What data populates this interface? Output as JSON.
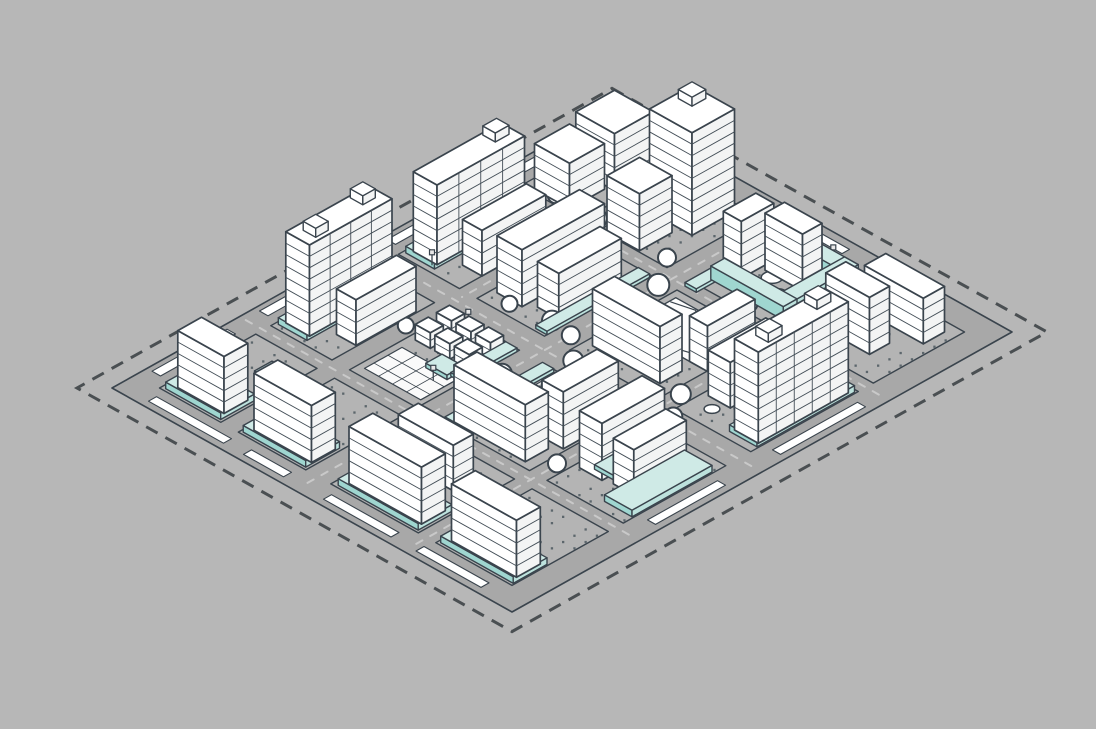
{
  "scene": {
    "kind": "isometric-urban-masterplan-illustration",
    "legend": {
      "water_platforms": "#cfeae6",
      "buildings": "#ffffff",
      "roads_ground": "#a8a8a8",
      "site_boundary": "dashed dark line",
      "trees": "white circles",
      "courtyards": "dotted gray"
    }
  },
  "colors": {
    "background": "#b7b7b7",
    "site": "#a8a8a8",
    "block": "#b4b4b4",
    "outline": "#3a444d",
    "stripe": "#434e57",
    "dash": "#4a4f52",
    "laneMark": "#c9c9c9",
    "median": "#ffffff",
    "dots": "#5c666c",
    "white": "#ffffff",
    "bldRight": "#f3f4f4",
    "waterTop": "#cfeae6",
    "waterLeft": "#9fd6d0",
    "waterRight": "#bde2dd",
    "parkFill": "#fcfcfc",
    "plazaFill": "#fafafa",
    "pondFill": "#ffffff",
    "glyph": "#3a444d"
  },
  "projection": {
    "origin": [
      612,
      108
    ],
    "ux": 25,
    "vy": 14,
    "zs": 30
  },
  "site": {
    "x": 0,
    "y": 0,
    "w": 16,
    "d": 20
  },
  "boundary": {
    "offset": 0.7,
    "dash": "13 9",
    "width": 3
  },
  "blocks": [
    {
      "id": "A1",
      "x": 0.95,
      "y": 0.95,
      "w": 2.45,
      "d": 3.65
    },
    {
      "id": "B1",
      "x": 4.1,
      "y": 0.95,
      "w": 2.7,
      "d": 3.65
    },
    {
      "id": "C1",
      "x": 7.8,
      "y": 0.95,
      "w": 3.5,
      "d": 3.65
    },
    {
      "id": "D1",
      "x": 12.0,
      "y": 0.95,
      "w": 3.05,
      "d": 3.65
    },
    {
      "id": "A2",
      "x": 0.95,
      "y": 5.2,
      "w": 2.45,
      "d": 4.3
    },
    {
      "id": "B2",
      "x": 4.1,
      "y": 5.2,
      "w": 2.7,
      "d": 4.3
    },
    {
      "id": "C2",
      "x": 7.8,
      "y": 5.2,
      "w": 3.5,
      "d": 4.3
    },
    {
      "id": "D2",
      "x": 12.0,
      "y": 5.2,
      "w": 3.05,
      "d": 4.3
    },
    {
      "id": "A3",
      "x": 0.95,
      "y": 10.5,
      "w": 2.45,
      "d": 4.1
    },
    {
      "id": "B3",
      "x": 4.1,
      "y": 10.5,
      "w": 2.7,
      "d": 4.1
    },
    {
      "id": "C3",
      "x": 7.8,
      "y": 10.5,
      "w": 3.5,
      "d": 4.1
    },
    {
      "id": "D3",
      "x": 12.0,
      "y": 10.5,
      "w": 3.05,
      "d": 4.1
    },
    {
      "id": "A4",
      "x": 0.95,
      "y": 15.2,
      "w": 2.45,
      "d": 3.85
    },
    {
      "id": "B4",
      "x": 4.1,
      "y": 15.2,
      "w": 2.7,
      "d": 3.85
    },
    {
      "id": "C4",
      "x": 7.8,
      "y": 15.2,
      "w": 3.5,
      "d": 3.85
    },
    {
      "id": "D4",
      "x": 12.0,
      "y": 15.2,
      "w": 3.05,
      "d": 3.85
    }
  ],
  "laneLines": [
    {
      "x1": 7.3,
      "y1": 0.25,
      "x2": 7.3,
      "y2": 19.75
    },
    {
      "x1": 0.25,
      "y1": 10.0,
      "x2": 15.75,
      "y2": 10.0
    },
    {
      "x1": 11.65,
      "y1": 0.25,
      "x2": 11.65,
      "y2": 19.75
    },
    {
      "x1": 3.75,
      "y1": 0.25,
      "x2": 3.75,
      "y2": 9.75
    },
    {
      "x1": 0.25,
      "y1": 4.9,
      "x2": 15.75,
      "y2": 4.9
    },
    {
      "x1": 0.25,
      "y1": 14.9,
      "x2": 15.75,
      "y2": 14.9
    }
  ],
  "medianStrips": [
    {
      "x": 0.2,
      "y": 1.2,
      "w": 0.34,
      "d": 3.2
    },
    {
      "x": 0.2,
      "y": 5.5,
      "w": 0.34,
      "d": 3.7
    },
    {
      "x": 0.2,
      "y": 10.8,
      "w": 0.34,
      "d": 3.5
    },
    {
      "x": 0.2,
      "y": 15.6,
      "w": 0.34,
      "d": 3.0
    },
    {
      "x": 1.2,
      "y": 19.42,
      "w": 3.0,
      "d": 0.32
    },
    {
      "x": 5.0,
      "y": 19.42,
      "w": 1.6,
      "d": 0.32
    },
    {
      "x": 8.2,
      "y": 19.42,
      "w": 2.7,
      "d": 0.32
    },
    {
      "x": 11.9,
      "y": 19.42,
      "w": 2.6,
      "d": 0.32
    },
    {
      "x": 15.42,
      "y": 5.6,
      "w": 0.32,
      "d": 3.4
    },
    {
      "x": 15.42,
      "y": 11.2,
      "w": 0.32,
      "d": 2.8
    },
    {
      "x": 8.3,
      "y": 0.3,
      "w": 1.5,
      "d": 0.3
    }
  ],
  "dotAreas": [
    {
      "x": 1.2,
      "y": 1.1,
      "w": 2.0,
      "d": 3.3
    },
    {
      "x": 4.2,
      "y": 1.0,
      "w": 2.5,
      "d": 3.4
    },
    {
      "x": 8.3,
      "y": 1.5,
      "w": 2.5,
      "d": 2.4
    },
    {
      "x": 12.1,
      "y": 1.0,
      "w": 2.8,
      "d": 3.3
    },
    {
      "x": 1.1,
      "y": 5.4,
      "w": 2.2,
      "d": 3.8
    },
    {
      "x": 4.2,
      "y": 5.4,
      "w": 2.4,
      "d": 3.8
    },
    {
      "x": 8.0,
      "y": 7.6,
      "w": 3.1,
      "d": 1.6
    },
    {
      "x": 12.1,
      "y": 5.4,
      "w": 2.7,
      "d": 3.8
    },
    {
      "x": 1.1,
      "y": 10.7,
      "w": 2.2,
      "d": 3.6
    },
    {
      "x": 4.2,
      "y": 10.7,
      "w": 2.4,
      "d": 1.8
    },
    {
      "x": 8.0,
      "y": 10.7,
      "w": 3.1,
      "d": 3.6
    },
    {
      "x": 12.1,
      "y": 10.7,
      "w": 2.7,
      "d": 3.6
    },
    {
      "x": 1.0,
      "y": 15.4,
      "w": 2.3,
      "d": 2.0
    },
    {
      "x": 4.2,
      "y": 15.4,
      "w": 2.4,
      "d": 2.0
    },
    {
      "x": 8.0,
      "y": 15.5,
      "w": 3.1,
      "d": 1.9
    },
    {
      "x": 12.1,
      "y": 15.4,
      "w": 2.7,
      "d": 2.0
    }
  ],
  "plaza": {
    "x": 4.35,
    "y": 12.75,
    "w": 2.25,
    "d": 1.5,
    "grid": 0.56
  },
  "park": {
    "x": 8.05,
    "y": 5.5,
    "w": 3.1,
    "d": 2.0,
    "curves": [
      [
        [
          8.1,
          5.75
        ],
        [
          8.9,
          5.55
        ],
        [
          9.7,
          6.35
        ],
        [
          10.5,
          5.95
        ],
        [
          11.1,
          6.3
        ]
      ],
      [
        [
          8.3,
          6.9
        ],
        [
          9.1,
          6.6
        ],
        [
          9.9,
          7.3
        ],
        [
          10.9,
          7.0
        ]
      ]
    ]
  },
  "ponds": [
    {
      "cx": 10.35,
      "cy": 6.7,
      "r": 0.33
    },
    {
      "cx": 9.25,
      "cy": 2.85,
      "r": 0.3
    },
    {
      "cx": 9.95,
      "cy": 3.3,
      "r": 0.24
    },
    {
      "cx": 9.7,
      "cy": 12.55,
      "r": 0.42
    },
    {
      "cx": 10.35,
      "cy": 12.3,
      "r": 0.3
    },
    {
      "cx": 8.85,
      "cy": 11.15,
      "r": 0.22
    },
    {
      "cx": 13.15,
      "cy": 7.0,
      "r": 0.3
    },
    {
      "cx": 12.75,
      "cy": 8.75,
      "r": 0.22
    },
    {
      "cx": 5.25,
      "cy": 2.1,
      "r": 0.26
    },
    {
      "cx": 2.1,
      "cy": 7.3,
      "r": 0.22
    }
  ],
  "playground": {
    "x": 8.35,
    "y": 10.95,
    "w": 1.05,
    "d": 0.95,
    "glyphs": [
      [
        8.62,
        11.3
      ],
      [
        9.02,
        11.5
      ],
      [
        8.72,
        11.72
      ]
    ]
  },
  "waterPrisms": [
    {
      "id": "w1",
      "x": 1.05,
      "y": 5.4,
      "w": 1.15,
      "d": 3.9,
      "h": 0.22,
      "k": 11.0
    },
    {
      "id": "w2",
      "x": 1.05,
      "y": 10.7,
      "w": 1.15,
      "d": 3.7,
      "h": 0.22,
      "k": 16.05
    },
    {
      "id": "w3",
      "x": 1.1,
      "y": 17.6,
      "w": 2.2,
      "d": 1.35,
      "h": 0.22,
      "k": 21.6
    },
    {
      "id": "w4",
      "x": 4.2,
      "y": 17.6,
      "w": 2.5,
      "d": 1.35,
      "h": 0.22,
      "k": 25.0
    },
    {
      "id": "w5",
      "x": 8.0,
      "y": 17.6,
      "w": 3.2,
      "d": 1.35,
      "h": 0.22,
      "k": 29.5
    },
    {
      "id": "w6",
      "x": 12.1,
      "y": 17.6,
      "w": 2.9,
      "d": 1.35,
      "h": 0.22,
      "k": 33.4
    },
    {
      "id": "w7",
      "x": 13.9,
      "y": 5.3,
      "w": 1.1,
      "d": 3.9,
      "h": 0.22,
      "k": 23.7
    },
    {
      "id": "w8",
      "x": 13.9,
      "y": 11.0,
      "w": 1.1,
      "d": 3.2,
      "h": 0.22
    },
    {
      "id": "w9",
      "x": 1.7,
      "y": 0.12,
      "w": 1.6,
      "d": 0.72,
      "h": 0.3
    },
    {
      "id": "c1",
      "x": 6.35,
      "y": 5.3,
      "w": 0.45,
      "d": 4.1,
      "h": 0.12
    },
    {
      "id": "c2",
      "x": 7.82,
      "y": 10.6,
      "w": 0.45,
      "d": 3.9,
      "h": 0.12
    },
    {
      "id": "c3",
      "x": 6.35,
      "y": 10.6,
      "w": 0.45,
      "d": 2.2,
      "h": 0.12
    },
    {
      "id": "c4",
      "x": 7.82,
      "y": 3.4,
      "w": 0.45,
      "d": 1.5,
      "h": 0.12
    },
    {
      "id": "u1",
      "x": 8.1,
      "y": 1.15,
      "w": 2.9,
      "d": 0.55,
      "h": 0.45
    },
    {
      "id": "u2",
      "x": 10.45,
      "y": 1.15,
      "w": 0.55,
      "d": 3.0,
      "h": 0.45
    },
    {
      "id": "u3",
      "x": 8.1,
      "y": 3.6,
      "w": 2.9,
      "d": 0.55,
      "h": 0.45
    },
    {
      "id": "s1",
      "x": 12.55,
      "y": 12.5,
      "w": 1.1,
      "d": 0.75,
      "h": 0.15
    },
    {
      "id": "s2",
      "x": 5.55,
      "y": 12.35,
      "w": 0.85,
      "d": 0.65,
      "h": 0.15
    },
    {
      "id": "s3",
      "x": 2.4,
      "y": 16.0,
      "w": 1.0,
      "d": 0.7,
      "h": 0.15
    }
  ],
  "buildings": [
    {
      "id": "A1a",
      "x": 1.45,
      "y": 1.35,
      "w": 1.55,
      "d": 1.55,
      "f": 5
    },
    {
      "id": "A1b",
      "x": 1.35,
      "y": 3.05,
      "w": 1.4,
      "d": 1.4,
      "f": 4
    },
    {
      "id": "A2t",
      "x": 1.15,
      "y": 5.6,
      "w": 0.95,
      "d": 3.5,
      "f": 7,
      "vm": 3,
      "roof": [
        {
          "dx": 0.08,
          "dy": 0.25,
          "w": 0.5,
          "d": 0.55,
          "h": 0.3
        }
      ]
    },
    {
      "id": "A2s",
      "x": 2.62,
      "y": 6.05,
      "w": 0.78,
      "d": 2.55,
      "f": 4
    },
    {
      "id": "A3t",
      "x": 1.15,
      "y": 10.9,
      "w": 0.95,
      "d": 3.3,
      "f": 8,
      "vm": 3,
      "roof": [
        {
          "dx": 0.08,
          "dy": 0.3,
          "w": 0.5,
          "d": 0.5,
          "h": 0.3
        },
        {
          "dx": 0.3,
          "dy": 2.4,
          "w": 0.5,
          "d": 0.5,
          "h": 0.3
        }
      ]
    },
    {
      "id": "A3s",
      "x": 2.58,
      "y": 11.2,
      "w": 0.78,
      "d": 2.4,
      "f": 4
    },
    {
      "id": "A4s",
      "x": 1.3,
      "y": 17.72,
      "w": 1.85,
      "d": 0.95,
      "f": 5
    },
    {
      "id": "B1t",
      "x": 4.45,
      "y": 1.25,
      "w": 1.7,
      "d": 1.7,
      "f": 9,
      "roof": [
        {
          "dx": 0.2,
          "dy": 0.2,
          "w": 0.55,
          "d": 0.55,
          "h": 0.3
        }
      ]
    },
    {
      "id": "B1c",
      "x": 4.35,
      "y": 3.25,
      "w": 1.3,
      "d": 1.3,
      "f": 5
    },
    {
      "id": "B2a",
      "x": 4.3,
      "y": 5.6,
      "w": 1.0,
      "d": 3.3,
      "f": 5
    },
    {
      "id": "B2b",
      "x": 5.62,
      "y": 6.1,
      "w": 0.85,
      "d": 2.5,
      "f": 4
    },
    {
      "id": "B4s",
      "x": 4.35,
      "y": 17.72,
      "w": 2.3,
      "d": 0.95,
      "f": 5
    },
    {
      "id": "C1a",
      "x": 8.85,
      "y": 1.95,
      "w": 1.5,
      "d": 0.78,
      "f": 5
    },
    {
      "id": "C1b",
      "x": 7.95,
      "y": 2.2,
      "w": 0.72,
      "d": 1.3,
      "f": 5
    },
    {
      "id": "C2s",
      "x": 8.1,
      "y": 8.0,
      "w": 2.7,
      "d": 0.88,
      "f": 5
    },
    {
      "id": "C2e",
      "x": 10.6,
      "y": 5.6,
      "w": 0.72,
      "d": 1.9,
      "f": 4
    },
    {
      "id": "C3s",
      "x": 8.05,
      "y": 13.45,
      "w": 2.85,
      "d": 0.92,
      "f": 5
    },
    {
      "id": "C3e",
      "x": 10.35,
      "y": 10.95,
      "w": 0.85,
      "d": 2.2,
      "f": 5
    },
    {
      "id": "C4a",
      "x": 8.3,
      "y": 16.05,
      "w": 2.2,
      "d": 0.8,
      "f": 4
    },
    {
      "id": "C4s",
      "x": 8.15,
      "y": 17.72,
      "w": 2.9,
      "d": 0.95,
      "f": 5
    },
    {
      "id": "D1a",
      "x": 12.3,
      "y": 1.35,
      "w": 2.35,
      "d": 0.85,
      "f": 4
    },
    {
      "id": "D1b",
      "x": 12.2,
      "y": 2.85,
      "w": 1.75,
      "d": 0.8,
      "f": 5
    },
    {
      "id": "D2t",
      "x": 13.95,
      "y": 5.45,
      "w": 0.95,
      "d": 3.6,
      "f": 8,
      "vm": 4,
      "roof": [
        {
          "dx": 0.1,
          "dy": 0.35,
          "w": 0.5,
          "d": 0.55,
          "h": 0.3
        },
        {
          "dx": 0.3,
          "dy": 2.5,
          "w": 0.5,
          "d": 0.55,
          "h": 0.3
        }
      ]
    },
    {
      "id": "D2s",
      "x": 12.2,
      "y": 6.05,
      "w": 0.88,
      "d": 2.3,
      "f": 4
    },
    {
      "id": "D3a",
      "x": 12.2,
      "y": 11.0,
      "w": 0.9,
      "d": 2.5,
      "f": 5
    },
    {
      "id": "D3b",
      "x": 13.45,
      "y": 11.3,
      "w": 0.82,
      "d": 2.1,
      "f": 4
    },
    {
      "id": "D4s",
      "x": 12.25,
      "y": 17.72,
      "w": 2.6,
      "d": 0.95,
      "f": 5
    },
    {
      "id": "h1",
      "x": 4.35,
      "y": 10.85,
      "w": 0.6,
      "d": 0.52,
      "f": 2,
      "fh": 0.26
    },
    {
      "id": "h2",
      "x": 5.13,
      "y": 10.85,
      "w": 0.6,
      "d": 0.52,
      "f": 2,
      "fh": 0.26
    },
    {
      "id": "h3",
      "x": 5.91,
      "y": 10.85,
      "w": 0.6,
      "d": 0.52,
      "f": 2,
      "fh": 0.26
    },
    {
      "id": "h4",
      "x": 4.35,
      "y": 11.7,
      "w": 0.6,
      "d": 0.52,
      "f": 2,
      "fh": 0.26
    },
    {
      "id": "h5",
      "x": 5.13,
      "y": 11.7,
      "w": 0.6,
      "d": 0.52,
      "f": 2,
      "fh": 0.26
    },
    {
      "id": "h6",
      "x": 5.91,
      "y": 11.7,
      "w": 0.6,
      "d": 0.52,
      "f": 2,
      "fh": 0.26
    }
  ],
  "trees": [
    {
      "x": 3.75,
      "y": 4.35,
      "r": 10
    },
    {
      "x": 2.1,
      "y": 4.35,
      "r": 8
    },
    {
      "x": 4.05,
      "y": 2.3,
      "r": 8
    },
    {
      "x": 6.55,
      "y": 4.35,
      "r": 9
    },
    {
      "x": 7.35,
      "y": 5.5,
      "r": 11
    },
    {
      "x": 6.5,
      "y": 8.9,
      "r": 10
    },
    {
      "x": 7.4,
      "y": 9.05,
      "r": 9
    },
    {
      "x": 8.35,
      "y": 9.9,
      "r": 10
    },
    {
      "x": 6.45,
      "y": 10.95,
      "r": 9
    },
    {
      "x": 7.4,
      "y": 11.8,
      "r": 10
    },
    {
      "x": 5.05,
      "y": 9.15,
      "r": 8
    },
    {
      "x": 9.35,
      "y": 10.1,
      "r": 9
    },
    {
      "x": 11.7,
      "y": 8.95,
      "r": 10
    },
    {
      "x": 12.35,
      "y": 9.9,
      "r": 9
    },
    {
      "x": 11.7,
      "y": 13.9,
      "r": 9
    },
    {
      "x": 11.6,
      "y": 4.35,
      "r": 9
    },
    {
      "x": 13.05,
      "y": 4.35,
      "r": 8
    },
    {
      "x": 3.7,
      "y": 7.5,
      "r": 8
    },
    {
      "x": 3.75,
      "y": 12.0,
      "r": 8
    },
    {
      "x": 9.85,
      "y": 4.35,
      "r": 8
    }
  ],
  "lamps": [
    {
      "x": 2.0,
      "y": 9.2
    },
    {
      "x": 4.85,
      "y": 10.6
    },
    {
      "x": 6.15,
      "y": 13.3
    },
    {
      "x": 8.95,
      "y": 13.2
    },
    {
      "x": 10.95,
      "y": 10.7
    },
    {
      "x": 12.6,
      "y": 10.75
    },
    {
      "x": 2.55,
      "y": 13.3
    },
    {
      "x": 9.85,
      "y": 1.0
    }
  ]
}
